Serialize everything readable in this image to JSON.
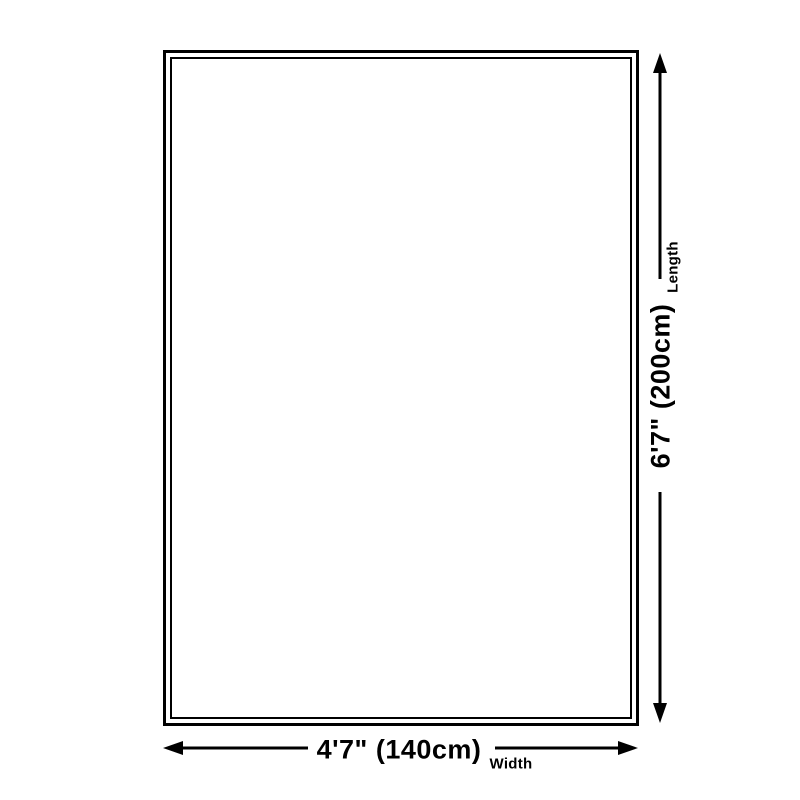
{
  "diagram": {
    "type": "product-size-diagram",
    "colors": {
      "background": "#ffffff",
      "line": "#000000",
      "text": "#000000"
    },
    "rug": {
      "border_style": "double"
    },
    "length": {
      "value": "6'7\" (200cm)",
      "label": "Length"
    },
    "width": {
      "value": "4'7\" (140cm)",
      "label": "Width"
    }
  }
}
